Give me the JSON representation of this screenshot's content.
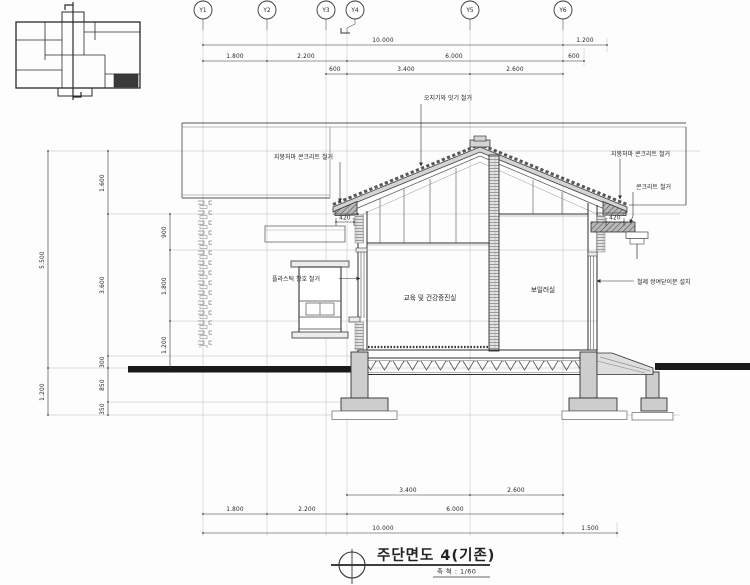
{
  "grid_bubbles": [
    "Y1",
    "Y2",
    "Y3",
    "Y4",
    "Y5",
    "Y6"
  ],
  "dims": {
    "top": {
      "row1": [
        "10.000",
        "1.200"
      ],
      "row2": [
        "1.800",
        "2.200",
        "6.000",
        "600"
      ],
      "row3": [
        "600",
        "3.400",
        "2.600"
      ]
    },
    "left": {
      "outer": [
        "5.500",
        "1.200"
      ],
      "middle": [
        "1.600",
        "3.600",
        "300",
        "850",
        "350"
      ],
      "inner": [
        "900",
        "1.800",
        "1.200"
      ]
    },
    "bottom": {
      "row1": [
        "3.400",
        "2.600"
      ],
      "row2": [
        "1.800",
        "2.200",
        "6.000"
      ],
      "row3": [
        "10.000",
        "1.500"
      ]
    },
    "eave_left": "420",
    "eave_right": "420"
  },
  "annotations": {
    "roof_tile_removal": "오지기와 잇기 철거",
    "left_eave_removal": "지붕처마 콘크리트 철거",
    "right_eave_removal": "지붕처마 콘크리트 철거",
    "concrete_removal": "콘크리트 철거",
    "window_removal": "플라스틱 창호 철거",
    "door_install": "철제 쌍여닫이문 설치"
  },
  "rooms": {
    "left": "교육 및 건강증진실",
    "right": "보일러실"
  },
  "title_block": {
    "title": "주단면도 4(기존)",
    "scale_label": "축 척 : 1/60"
  },
  "colors": {
    "line": "#2f2f2f",
    "faint": "#b9b9b9",
    "ground": "#1a1a1a",
    "concrete_fill": "#cdcdcd",
    "roof_fill": "#d4d4d4"
  }
}
